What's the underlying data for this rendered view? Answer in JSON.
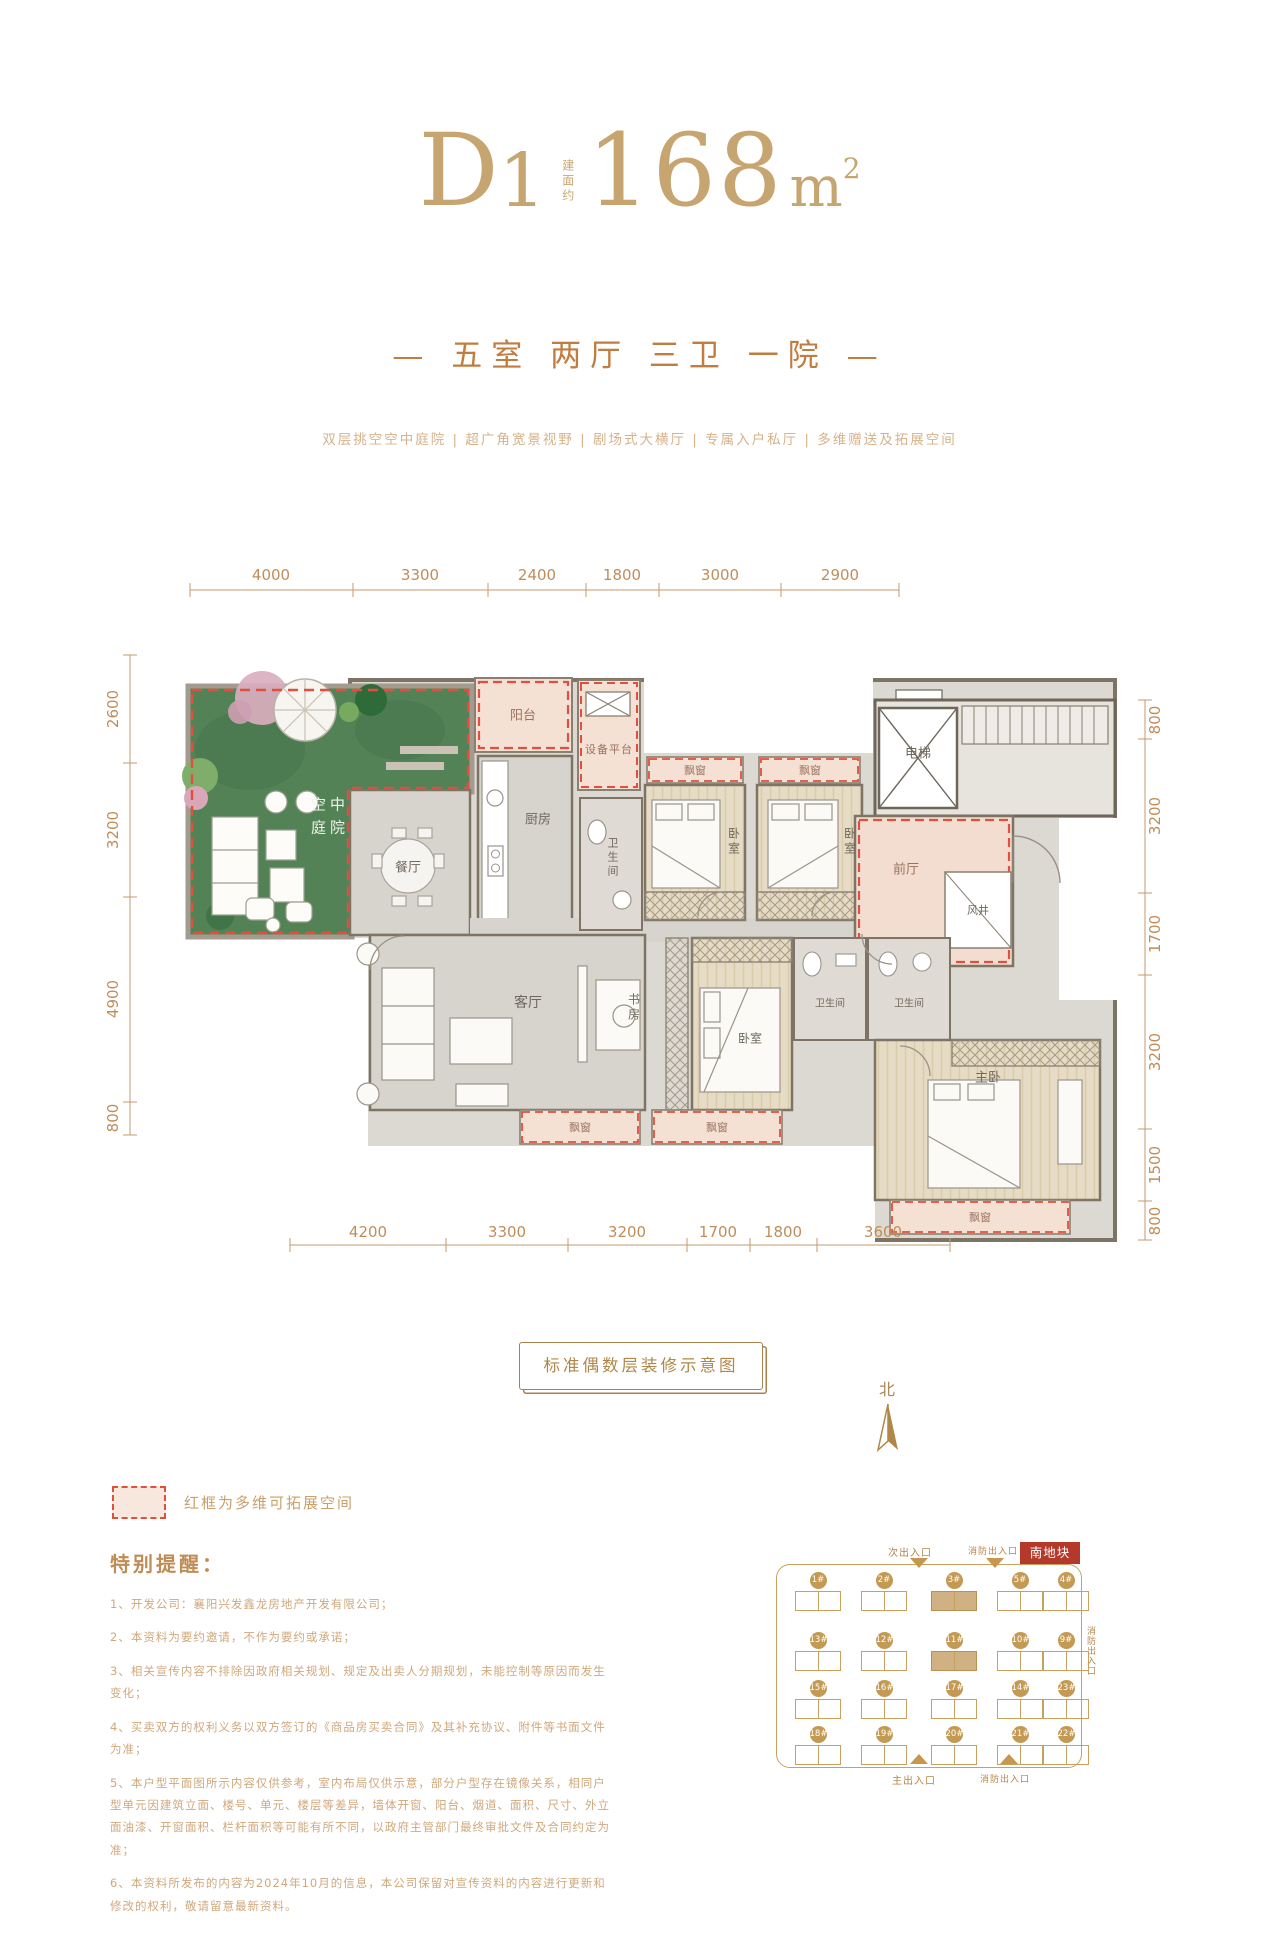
{
  "header": {
    "unit": "D1",
    "area_prefix": "建面约",
    "area_value": "168",
    "area_unit_base": "m",
    "area_unit_sup": "2",
    "subtitle": "— 五室 两厅 三卫 一院 —",
    "features": "双层挑空空中庭院 | 超广角宽景视野 | 剧场式大横厅 | 专属入户私厅 | 多维赠送及拓展空间"
  },
  "plan": {
    "rooms": {
      "courtyard": "空中庭院",
      "balcony": "阳台",
      "equipment": "设备平台",
      "kitchen": "厨房",
      "dining": "餐厅",
      "bath": "卫生间",
      "bedroom": "卧室",
      "bay_window": "飘窗",
      "elevator": "电梯",
      "foyer": "前厅",
      "shaft": "风井",
      "living": "客厅",
      "study": "书房",
      "master": "主卧"
    },
    "dims_top": [
      "4000",
      "3300",
      "2400",
      "1800",
      "3000",
      "2900"
    ],
    "dims_left": [
      "2600",
      "3200",
      "4900",
      "800"
    ],
    "dims_right": [
      "800",
      "3200",
      "1700",
      "3200",
      "1500",
      "800"
    ],
    "dims_bottom": [
      "4200",
      "3300",
      "3200",
      "1700",
      "1800",
      "3600"
    ]
  },
  "caption": "标准偶数层装修示意图",
  "north": {
    "label": "北"
  },
  "legend": {
    "text": "红框为多维可拓展空间"
  },
  "notice": {
    "title": "特别提醒：",
    "items": [
      "1、开发公司：襄阳兴发鑫龙房地产开发有限公司；",
      "2、本资料为要约邀请，不作为要约或承诺；",
      "3、相关宣传内容不排除因政府相关规划、规定及出卖人分期规划，未能控制等原因而发生变化；",
      "4、买卖双方的权利义务以双方签订的《商品房买卖合同》及其补充协议、附件等书面文件为准；",
      "5、本户型平面图所示内容仅供参考，室内布局仅供示意，部分户型存在镜像关系，相同户型单元因建筑立面、楼号、单元、楼层等差异，墙体开窗、阳台、烟道、面积、尺寸、外立面油漆、开窗面积、栏杆面积等可能有所不同，以政府主管部门最终审批文件及合同约定为准；",
      "6、本资料所发布的内容为2024年10月的信息，本公司保留对宣传资料的内容进行更新和修改的权利，敬请留意最新资料。"
    ]
  },
  "siteplan": {
    "plot_label": "南地块",
    "entrances": {
      "top_secondary": "次出入口",
      "top_fire": "消防出入口",
      "bottom_main": "主出入口",
      "bottom_fire": "消防出入口",
      "right_fire": "消防出入口"
    },
    "badges": [
      "1#",
      "2#",
      "3#",
      "5#",
      "4#",
      "13#",
      "12#",
      "11#",
      "10#",
      "9#",
      "15#",
      "16#",
      "17#",
      "14#",
      "23#",
      "18#",
      "19#",
      "20#",
      "21#",
      "22#"
    ],
    "highlighted": [
      "3#",
      "11#"
    ]
  }
}
